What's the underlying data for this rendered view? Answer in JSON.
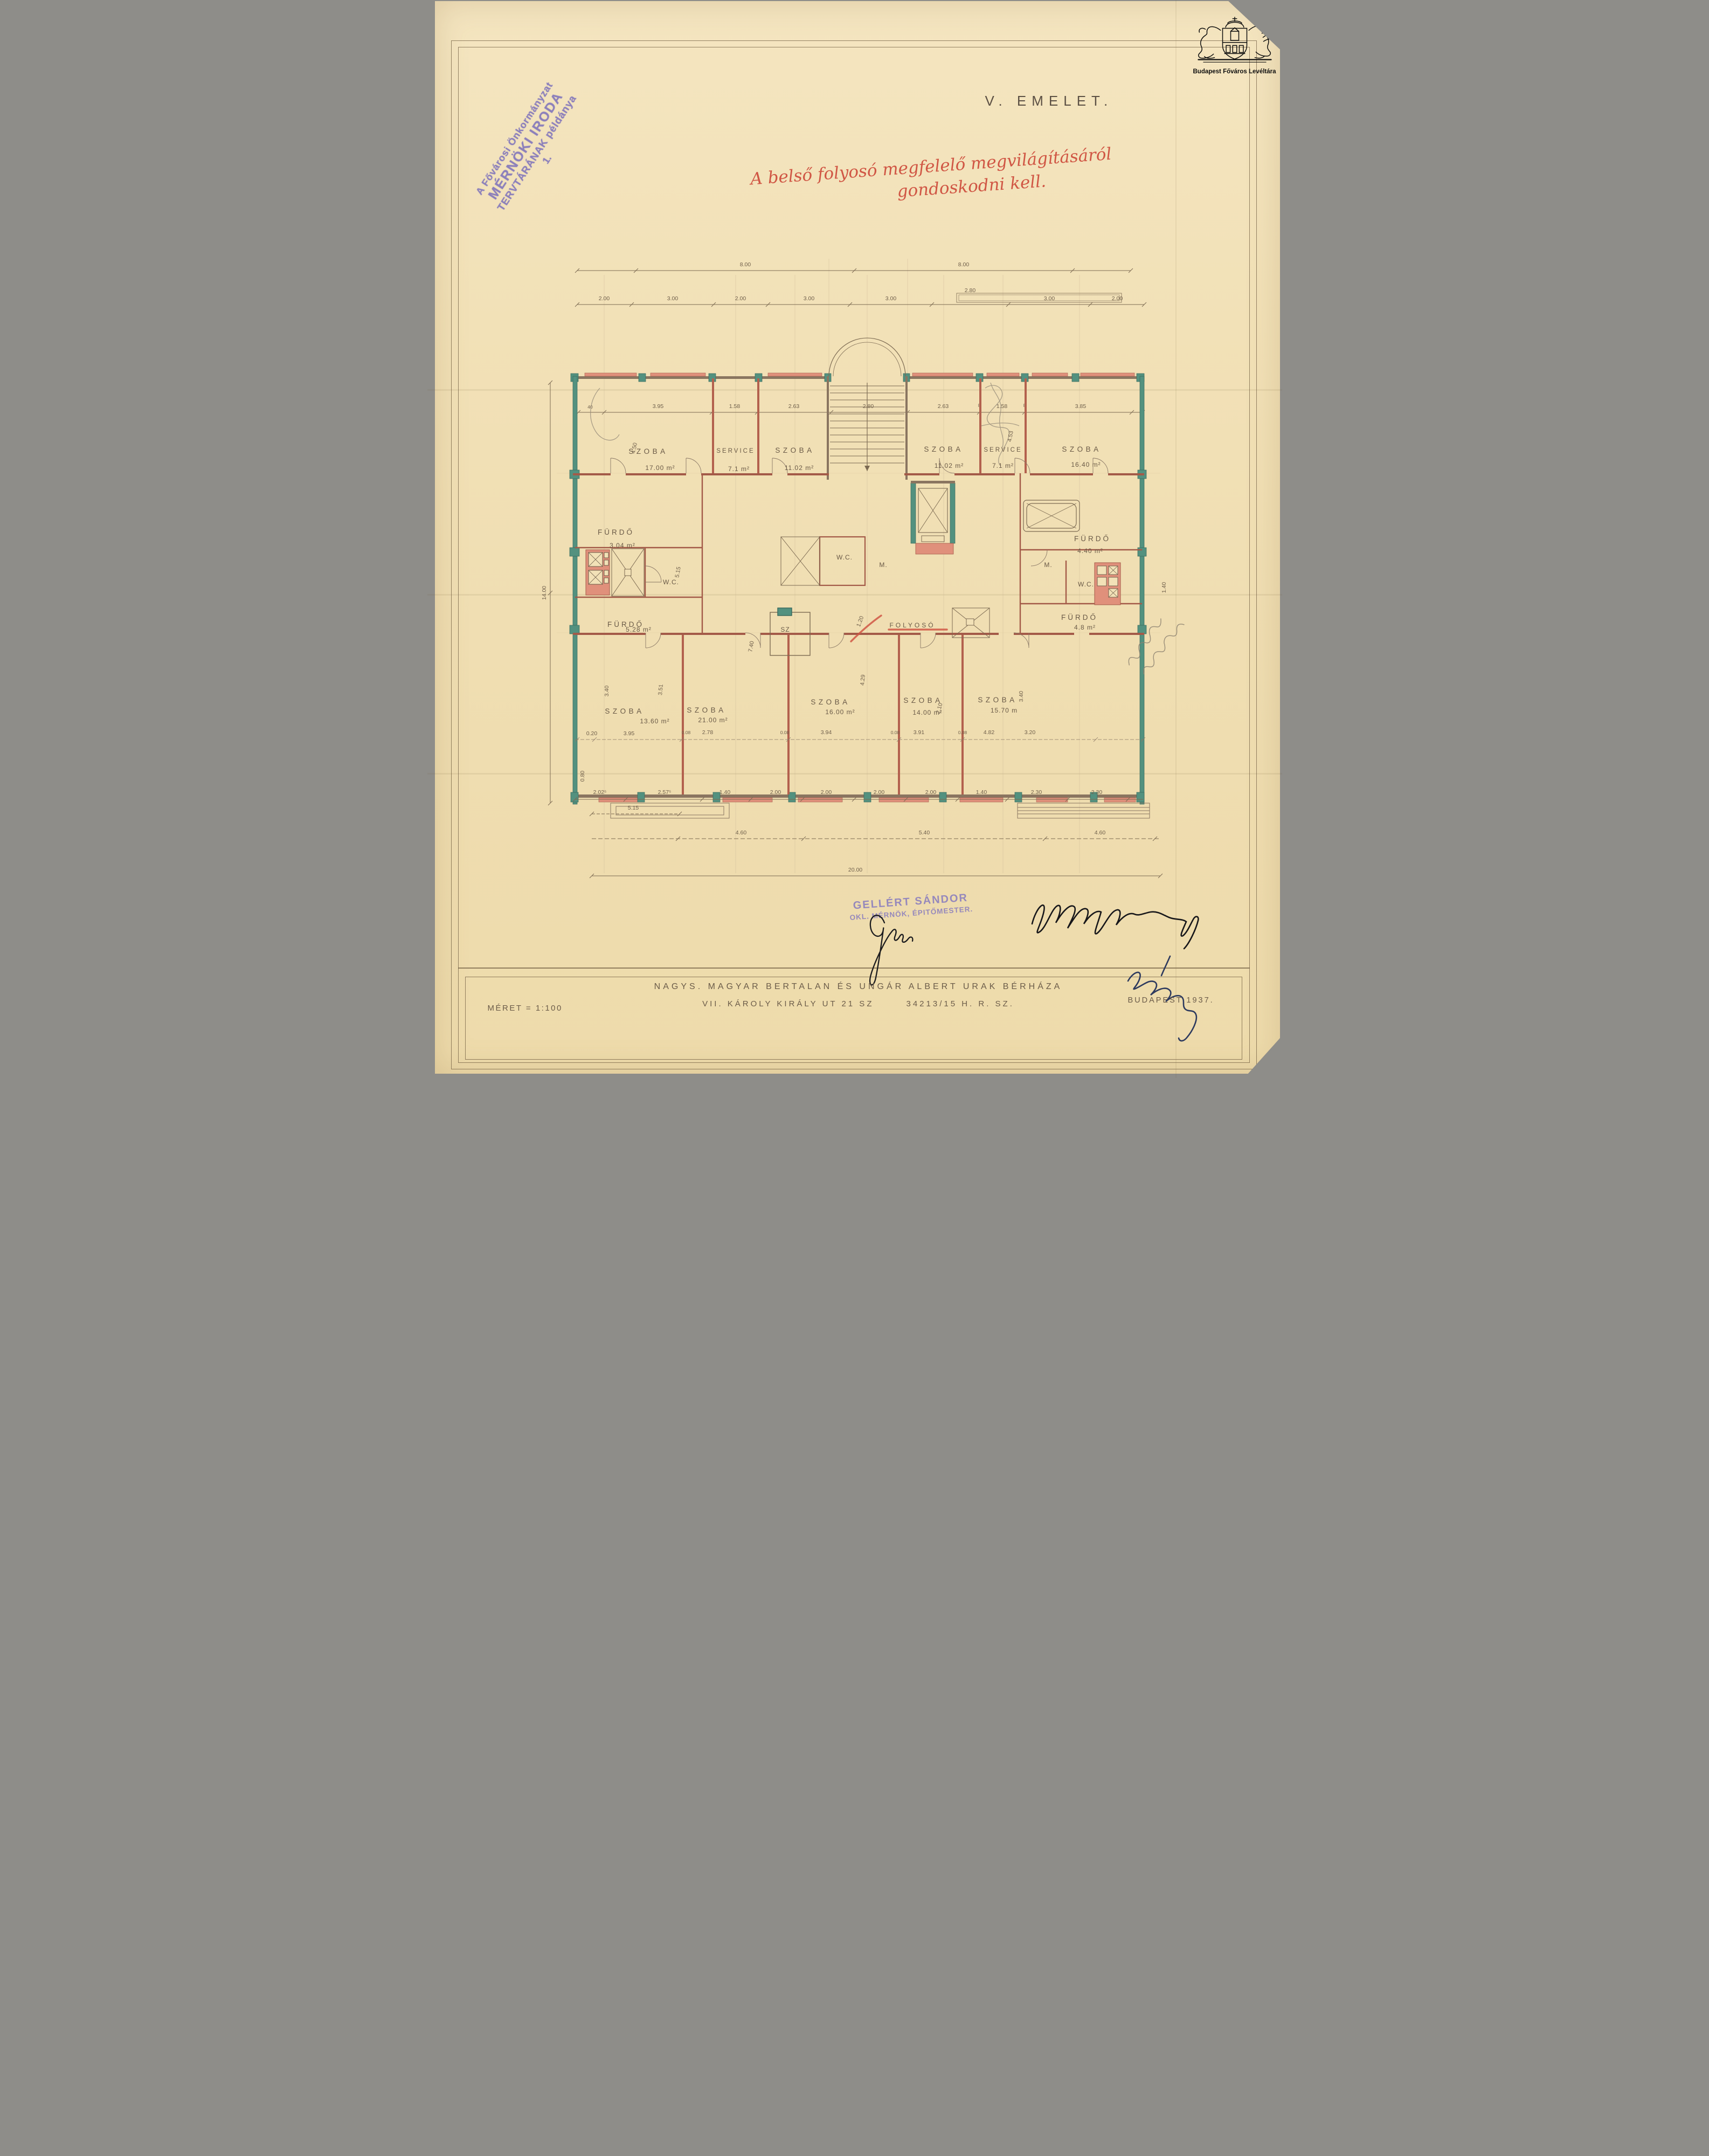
{
  "logo": {
    "name": "Budapest Főváros Levéltára"
  },
  "archive_stamp": {
    "line1": "A Fővárosi Önkormányzat",
    "line2": "MÉRNÖKI IRODA",
    "line3": "TERVTÁRÁNAK példánya",
    "line4": "1."
  },
  "floor_title": "V. EMELET.",
  "red_note": {
    "line1": "A belső folyosó megfelelő megvilágításáról",
    "line2": "gondoskodni kell."
  },
  "architect_stamp": {
    "line1": "GELLÉRT SÁNDOR",
    "line2": "OKL. MÉRNÖK, ÉPITŐMESTER."
  },
  "title_block": {
    "scale": "MÉRET = 1:100",
    "owners": "NAGYS. MAGYAR BERTALAN ÉS UNGÁR ALBERT URAK BÉRHÁZA",
    "address": "VII. KÁROLY KIRÁLY UT 21 SZ",
    "parcel": "34213/15 H. R. SZ.",
    "city_year": "BUDAPEST 1937."
  },
  "colors": {
    "wall_teal": "#53917f",
    "wall_salmon": "#e0907b",
    "ink_brown": "#6a5a47",
    "red_ink": "#d05644",
    "stamp_purple": "#8579bb"
  },
  "plan": {
    "rooms": [
      {
        "label": "SZOBA",
        "area": "17.00 m²"
      },
      {
        "label": "SERVICE",
        "area": "7.1 m²"
      },
      {
        "label": "SZOBA",
        "area": "11.02 m²"
      },
      {
        "label": "SZOBA",
        "area": "11.02 m²"
      },
      {
        "label": "SERVICE",
        "area": "7.1 m²"
      },
      {
        "label": "SZOBA",
        "area": "16.40 m²"
      },
      {
        "label": "FÜRDŐ",
        "area": "3.04 m²"
      },
      {
        "label": "W.C."
      },
      {
        "label": "FÜRDŐ",
        "area": "5.28 m²"
      },
      {
        "label": "W.C."
      },
      {
        "label": "M."
      },
      {
        "label": "FOLYOSÓ"
      },
      {
        "label": "FÜRDŐ",
        "area": "4.40 m²"
      },
      {
        "label": "M."
      },
      {
        "label": "W.C."
      },
      {
        "label": "FÜRDŐ",
        "area": "4.8 m²"
      },
      {
        "label": "SZ"
      },
      {
        "label": "SZOBA",
        "area": "13.60 m²"
      },
      {
        "label": "SZOBA",
        "area": "21.00 m²"
      },
      {
        "label": "SZOBA",
        "area": "16.00 m²"
      },
      {
        "label": "SZOBA",
        "area": "14.00 m²"
      },
      {
        "label": "SZOBA",
        "area": "15.70 m"
      }
    ],
    "dims": {
      "top_outer": [
        "8.00",
        "8.00"
      ],
      "top_axes": [
        "2.00",
        "3.00",
        "2.00",
        "3.00",
        "3.00",
        "2.80",
        "3.00",
        "2.00"
      ],
      "top_interior": [
        "40",
        "3.95",
        "8",
        "1.58",
        "8",
        "2.63",
        "2.80",
        "2.63",
        "8",
        "1.58",
        "8",
        "3.85"
      ],
      "verticals": [
        "4.50",
        "4.53",
        "5.15",
        "7.40",
        "4.29",
        "1.20",
        "14.00",
        "1.40",
        "3.40",
        "3.51",
        "2.10",
        "3.40",
        "0.80"
      ],
      "bottom_interior": [
        "0.20",
        "3.95",
        "0.08",
        "2.78",
        "0.08",
        "3.94",
        "0.08",
        "3.91",
        "0.08",
        "4.82",
        "3.20"
      ],
      "bottom_axes": [
        "2.02⁵",
        "2.57⁵",
        "1.40",
        "2.00",
        "2.00",
        "2.00",
        "2.00",
        "1.40",
        "2.30",
        "2.30"
      ],
      "bottom_outer": [
        "5.15",
        "4.60",
        "5.40",
        "4.60",
        "20.00"
      ]
    }
  }
}
